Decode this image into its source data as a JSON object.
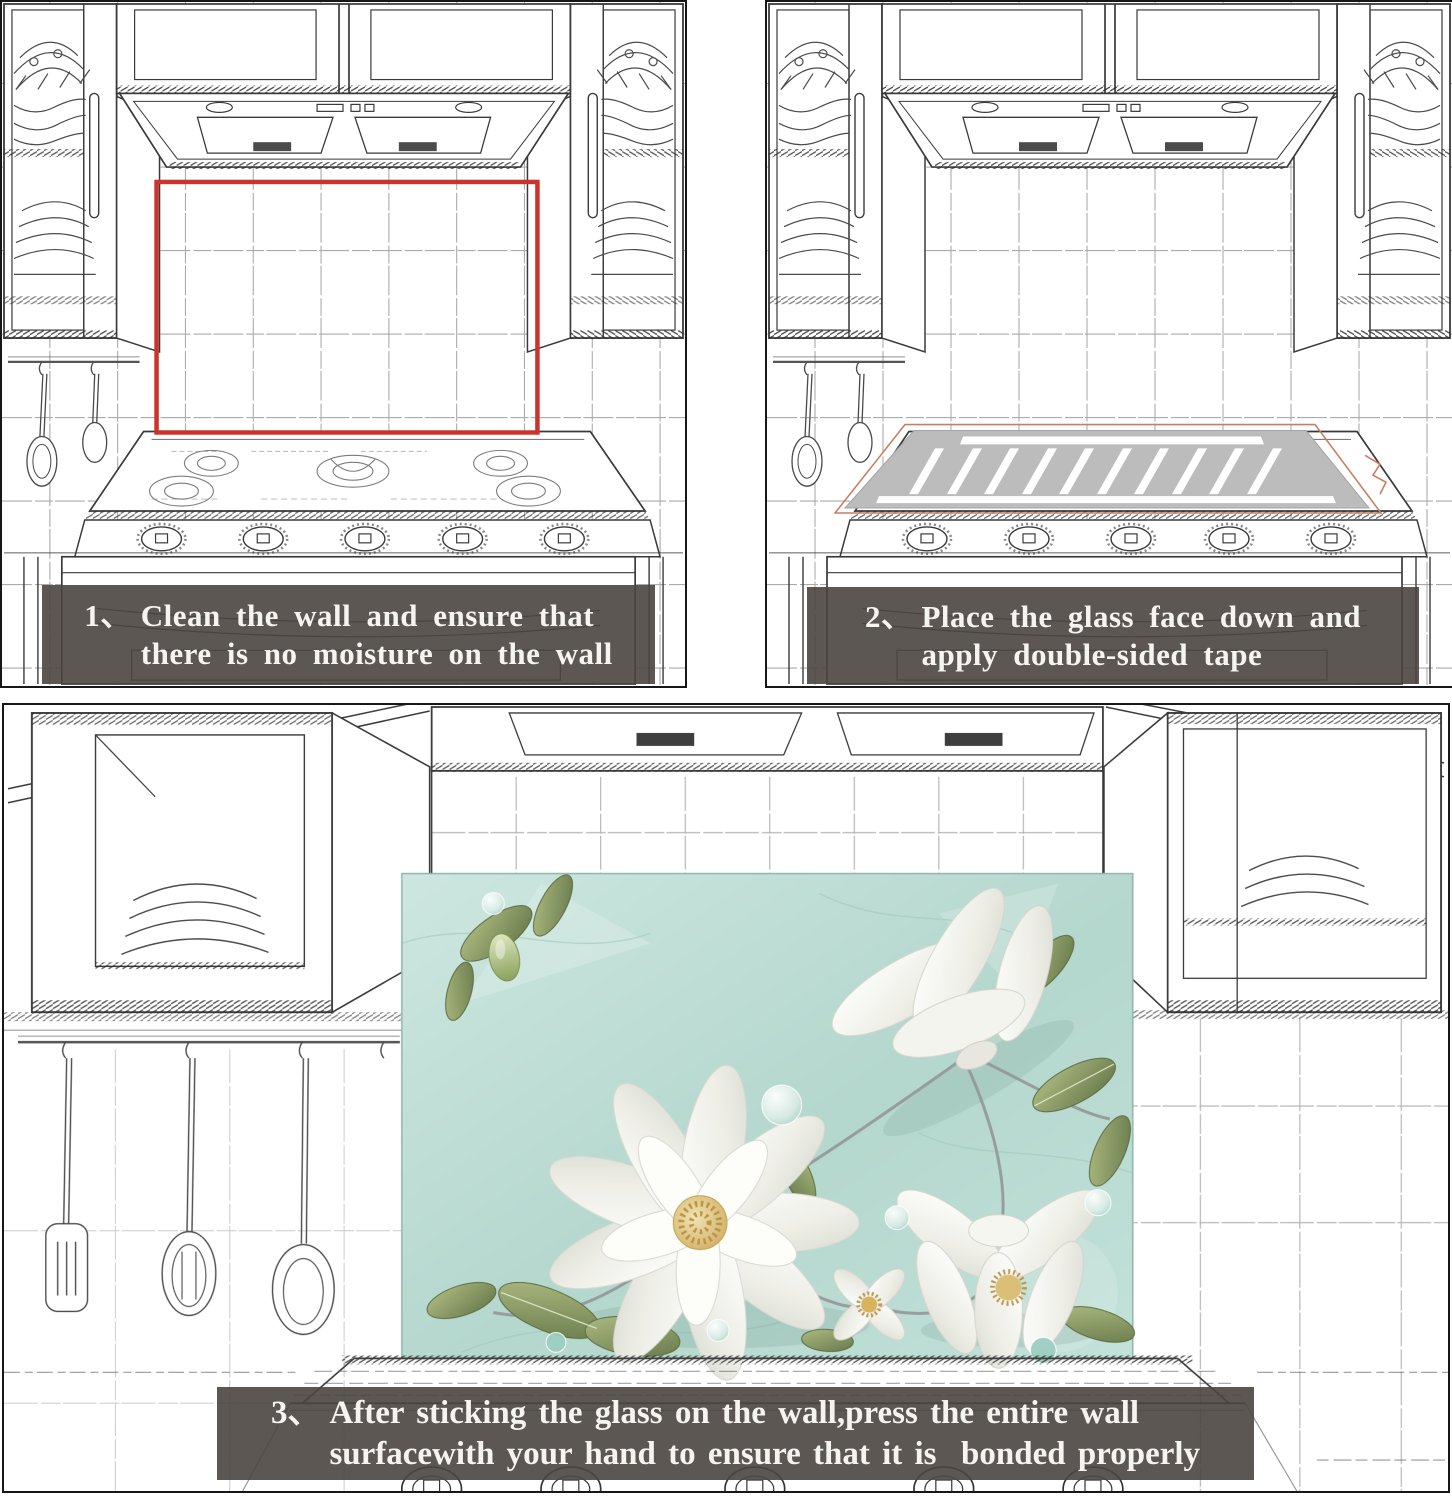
{
  "canvas": {
    "width": 1452,
    "height": 1500
  },
  "steps": [
    {
      "number": "1、",
      "line1": "Clean the wall and ensure that",
      "line2": "there is no moisture on the wall"
    },
    {
      "number": "2、",
      "line1": "Place the glass face down and",
      "line2": "apply double-sided tape"
    },
    {
      "number": "3、",
      "line1": "After sticking the glass on the wall,press the entire wall",
      "line2": "surfacewith your hand to ensure that it is  bonded properly"
    }
  ],
  "colors": {
    "panel_border": "#171717",
    "sketch_line": "#3a3a3a",
    "tile_line": "#8f8f8f",
    "banner_bg": "rgba(74,69,64,0.9)",
    "banner_text": "#f6f4f0",
    "highlight_red": "#cb342c",
    "glass_gray": "#bcbcbc",
    "tape_stripe_white": "#ffffff",
    "tape_outline": "#c97f63",
    "backsplash_mint": "#b7d8d0",
    "leaf_green": "#74854e",
    "flower_white": "#f7f7f2",
    "flower_center_gold": "#c9a050"
  },
  "artwork": {
    "name": "white-flower-backsplash-art"
  }
}
